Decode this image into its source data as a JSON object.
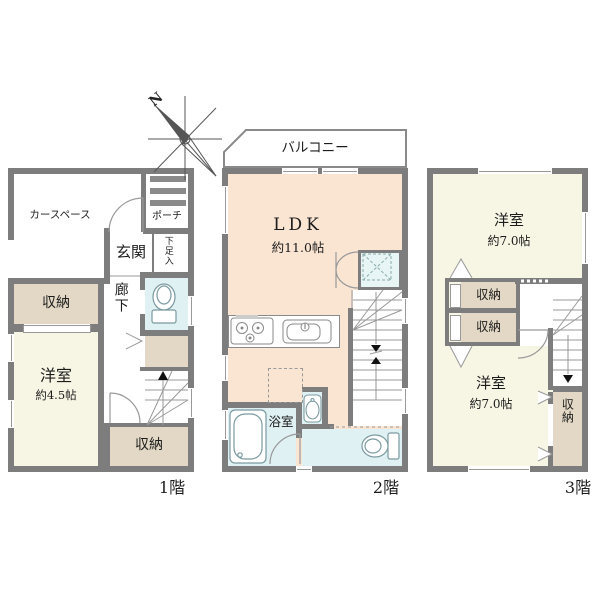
{
  "compass": {
    "north_label": "N"
  },
  "floor1": {
    "floor_label": "1階",
    "car_space": "カースペース",
    "porch": "ポーチ",
    "entrance": "玄関",
    "shoe_closet": "下足入",
    "hallway": "廊下",
    "storage_upper": "収納",
    "bedroom": "洋室",
    "bedroom_size": "約4.5帖",
    "storage_lower": "収納"
  },
  "floor2": {
    "floor_label": "2階",
    "balcony": "バルコニー",
    "ldk": "LDK",
    "ldk_size": "約11.0帖",
    "bathroom": "浴室"
  },
  "floor3": {
    "floor_label": "3階",
    "bedroom_top": "洋室",
    "bedroom_top_size": "約7.0帖",
    "storage_a": "収納",
    "storage_b": "収納",
    "bedroom_bottom": "洋室",
    "bedroom_bottom_size": "約7.0帖",
    "storage_side": "収納"
  },
  "colors": {
    "wall": "#7d7d7d",
    "room_cream": "#f7f5e4",
    "room_peach": "#fae5d3",
    "room_beige": "#e2d8c5",
    "wet_blue": "#dff1f3",
    "symbol_line": "#999999"
  }
}
